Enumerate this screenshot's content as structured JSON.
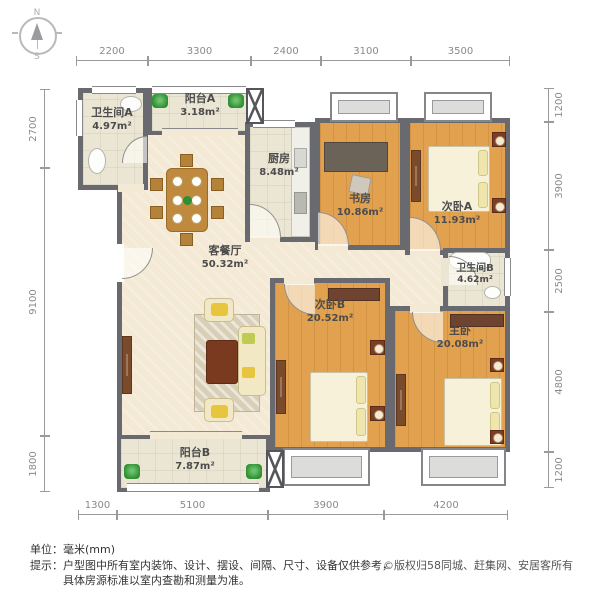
{
  "compass": {
    "north": "N",
    "south": "S"
  },
  "rooms": {
    "bathroom_a": {
      "name": "卫生间A",
      "area": "4.97m²"
    },
    "balcony_a": {
      "name": "阳台A",
      "area": "3.18m²"
    },
    "kitchen": {
      "name": "厨房",
      "area": "8.48m²"
    },
    "study": {
      "name": "书房",
      "area": "10.86m²"
    },
    "bedroom_a": {
      "name": "次卧A",
      "area": "11.93m²"
    },
    "living_dining": {
      "name": "客餐厅",
      "area": "50.32m²"
    },
    "bathroom_b": {
      "name": "卫生间B",
      "area": "4.62m²"
    },
    "bedroom_b": {
      "name": "次卧B",
      "area": "20.52m²"
    },
    "master_bedroom": {
      "name": "主卧",
      "area": "20.08m²"
    },
    "balcony_b": {
      "name": "阳台B",
      "area": "7.87m²"
    }
  },
  "dimensions": {
    "top": [
      "2200",
      "3300",
      "2400",
      "3100",
      "3500"
    ],
    "bottom": [
      "1300",
      "5100",
      "3900",
      "4200"
    ],
    "left": [
      "2700",
      "9100",
      "1800"
    ],
    "right": [
      "1200",
      "3900",
      "2500",
      "4800",
      "1200"
    ]
  },
  "footer": {
    "unit_label": "单位：毫米(mm)",
    "tip_line1": "提示：户型图中所有室内装饰、设计、摆设、间隔、尺寸、设备仅供参考，",
    "tip_line2": "具体房源标准以室内查勘和测量为准。",
    "copyright": "©版权归58同城、赶集网、安居客所有"
  },
  "colors": {
    "wall": "#696970",
    "wood_floor": "#E2A14F",
    "living_floor": "#F3E9D4",
    "tile_floor": "#EAE6D3",
    "plant_green": "#2F8F33"
  }
}
